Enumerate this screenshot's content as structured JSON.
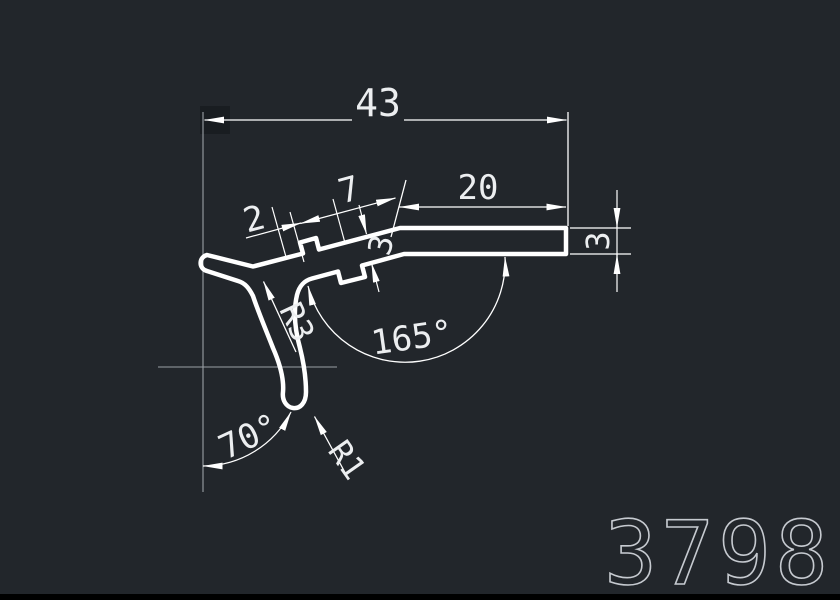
{
  "drawing": {
    "part_number": "3798",
    "dimensions": {
      "overall_width": "43",
      "flat_length": "20",
      "tooth_span": "7",
      "lip_length": "2",
      "strip_thickness": "3",
      "bar_thickness": "3",
      "open_angle": "165°",
      "leg_angle": "70°",
      "tip_radius": "R1",
      "fillet_radius": "R3"
    },
    "colors": {
      "background": "#22262b",
      "profile_line": "#ffffff",
      "construction_line": "#9aa0a6",
      "part_number_text": "#c6cad0",
      "bottom_bar": "#000000"
    }
  }
}
